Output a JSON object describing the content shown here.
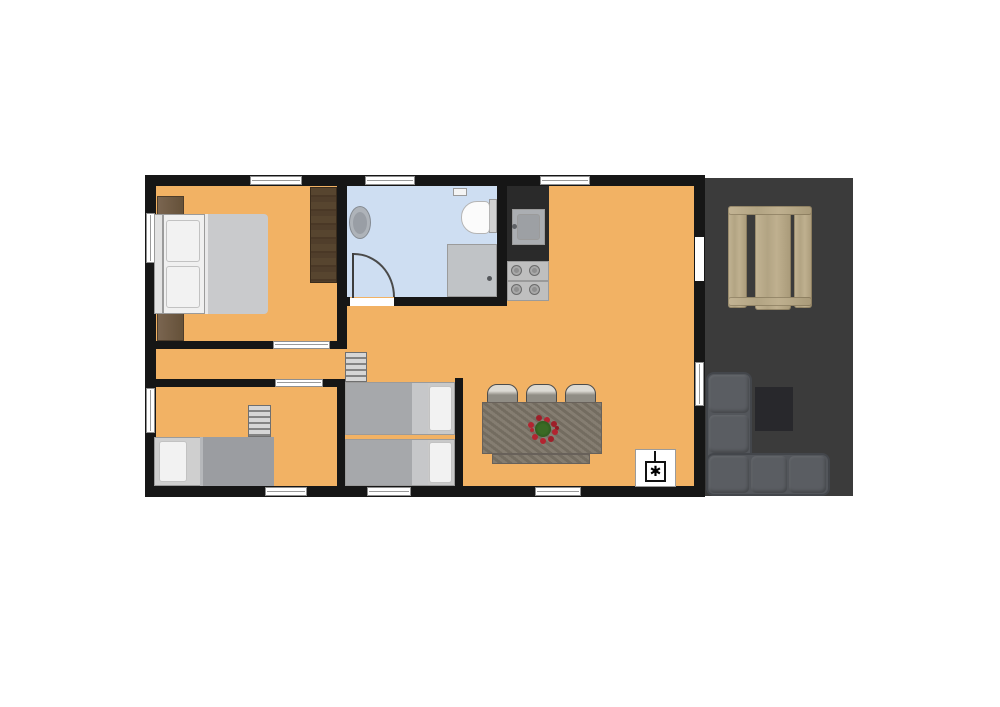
{
  "plan": {
    "canvas": {
      "width": 1000,
      "height": 707
    },
    "colors": {
      "wall": "#161616",
      "floor": "#F2B264",
      "bathroom_floor": "#CEDEF2",
      "terrace_deck": "#3B3B3B",
      "picnic_table_wood": "#B7A888",
      "kitchen_counter": "#2A2A2A",
      "sofa": "#53565B",
      "bed_blanket": "#A6A8AB",
      "plant_green": "#2F5C1E",
      "plant_red": "#B22430"
    },
    "symbols": {
      "heater": "✱"
    },
    "elements": [
      {
        "name": "terrace-deck",
        "rect": [
          703,
          178,
          150,
          318
        ],
        "bg": "#3B3B3B"
      },
      {
        "name": "picnic-table-left-bench",
        "cls": "wood",
        "rect": [
          728,
          208,
          19,
          100
        ]
      },
      {
        "name": "picnic-table-top",
        "cls": "wood",
        "rect": [
          755,
          206,
          36,
          104
        ]
      },
      {
        "name": "picnic-table-right-bench",
        "cls": "wood",
        "rect": [
          794,
          208,
          18,
          100
        ]
      },
      {
        "name": "picnic-table-crossbar-top",
        "cls": "wood",
        "rect": [
          728,
          206,
          84,
          9
        ]
      },
      {
        "name": "picnic-table-crossbar-bottom",
        "cls": "wood",
        "rect": [
          728,
          297,
          84,
          9
        ]
      },
      {
        "name": "terrace-side-table",
        "rect": [
          755,
          387,
          38,
          44
        ],
        "bg": "#28282C"
      },
      {
        "name": "sofa-chaise-section",
        "cls": "sofa",
        "rect": [
          706,
          372,
          46,
          124
        ]
      },
      {
        "name": "sofa-base-section",
        "cls": "sofa",
        "rect": [
          706,
          453,
          124,
          43
        ]
      },
      {
        "name": "sofa-cushion",
        "cls": "cushion",
        "rect": [
          709,
          375,
          40,
          38
        ]
      },
      {
        "name": "sofa-cushion",
        "cls": "cushion",
        "rect": [
          709,
          415,
          40,
          38
        ]
      },
      {
        "name": "sofa-cushion",
        "cls": "cushion",
        "rect": [
          709,
          456,
          40,
          37
        ]
      },
      {
        "name": "sofa-cushion",
        "cls": "cushion",
        "rect": [
          751,
          456,
          36,
          37
        ]
      },
      {
        "name": "sofa-cushion",
        "cls": "cushion",
        "rect": [
          789,
          456,
          37,
          37
        ]
      },
      {
        "name": "house-floor",
        "rect": [
          150,
          180,
          550,
          312
        ],
        "bg": "#F2B264"
      },
      {
        "name": "bathroom-floor",
        "rect": [
          347,
          186,
          150,
          111
        ],
        "bg": "#CEDEF2"
      },
      {
        "name": "wall-top",
        "rect": [
          145,
          175,
          560,
          11
        ],
        "bg": "#161616"
      },
      {
        "name": "wall-bottom",
        "rect": [
          145,
          486,
          560,
          11
        ],
        "bg": "#161616"
      },
      {
        "name": "wall-left",
        "rect": [
          145,
          175,
          11,
          322
        ],
        "bg": "#161616"
      },
      {
        "name": "wall-right",
        "rect": [
          694,
          175,
          11,
          322
        ],
        "bg": "#161616"
      },
      {
        "name": "wall-bathroom-left",
        "rect": [
          337,
          186,
          10,
          163
        ],
        "bg": "#161616"
      },
      {
        "name": "wall-bathroom-right",
        "rect": [
          497,
          186,
          10,
          120
        ],
        "bg": "#161616"
      },
      {
        "name": "wall-bathroom-bottom-left",
        "rect": [
          337,
          297,
          13,
          9
        ],
        "bg": "#161616"
      },
      {
        "name": "wall-bathroom-bottom-right",
        "rect": [
          394,
          297,
          113,
          9
        ],
        "bg": "#161616"
      },
      {
        "name": "wall-bedroom-bottom-left",
        "rect": [
          145,
          341,
          128,
          8
        ],
        "bg": "#161616"
      },
      {
        "name": "wall-bedroom-bottom-right",
        "rect": [
          330,
          341,
          17,
          8
        ],
        "bg": "#161616"
      },
      {
        "name": "wall-hall-bottom-left",
        "rect": [
          145,
          379,
          130,
          8
        ],
        "bg": "#161616"
      },
      {
        "name": "wall-hall-bottom-right",
        "rect": [
          323,
          379,
          22,
          8
        ],
        "bg": "#161616"
      },
      {
        "name": "wall-alcove-left",
        "rect": [
          337,
          383,
          8,
          103
        ],
        "bg": "#161616"
      },
      {
        "name": "wall-alcove-right",
        "rect": [
          455,
          378,
          8,
          108
        ],
        "bg": "#161616"
      },
      {
        "name": "kitchen-counter",
        "rect": [
          507,
          186,
          42,
          75
        ],
        "bg": "#2A2A2A"
      },
      {
        "name": "window-top-bedroom",
        "cls": "win-h",
        "rect": [
          250,
          176,
          52,
          9
        ]
      },
      {
        "name": "window-top-bathroom",
        "cls": "win-h",
        "rect": [
          365,
          176,
          50,
          9
        ]
      },
      {
        "name": "window-top-living",
        "cls": "win-h",
        "rect": [
          540,
          176,
          50,
          9
        ]
      },
      {
        "name": "window-bottom-left-room",
        "cls": "win-h",
        "rect": [
          265,
          487,
          42,
          9
        ]
      },
      {
        "name": "window-bottom-alcove",
        "cls": "win-h",
        "rect": [
          367,
          487,
          44,
          9
        ]
      },
      {
        "name": "window-bottom-living",
        "cls": "win-h",
        "rect": [
          535,
          487,
          46,
          9
        ]
      },
      {
        "name": "window-left-bedroom",
        "cls": "win-v",
        "rect": [
          146,
          213,
          9,
          50
        ]
      },
      {
        "name": "window-left-bottom-room",
        "cls": "win-v",
        "rect": [
          146,
          388,
          9,
          45
        ]
      },
      {
        "name": "window-right-living",
        "cls": "win-v",
        "rect": [
          695,
          362,
          9,
          44
        ]
      },
      {
        "name": "entry-door-opening",
        "cls": "door-open",
        "rect": [
          695,
          237,
          9,
          44
        ]
      },
      {
        "name": "bathroom-door-opening",
        "cls": "door-open",
        "rect": [
          350,
          298,
          44,
          8
        ]
      },
      {
        "name": "bedroom-door-opening",
        "cls": "win-h",
        "rect": [
          273,
          341,
          57,
          8
        ]
      },
      {
        "name": "bottom-room-door-opening",
        "cls": "win-h",
        "rect": [
          275,
          379,
          48,
          8
        ]
      },
      {
        "name": "bathroom-door-leaf",
        "rect": [
          352,
          253,
          2,
          45
        ],
        "bg": "#3d3d3d"
      },
      {
        "name": "bathroom-door-swing-arc",
        "cls": "arc",
        "rect": [
          354,
          253,
          41,
          44
        ]
      },
      {
        "name": "bathroom-shelf",
        "cls": "thin-border",
        "rect": [
          453,
          188,
          14,
          8
        ],
        "bg": "#F4F4F4"
      },
      {
        "name": "toilet-tank",
        "cls": "thin-border",
        "rect": [
          489,
          199,
          8,
          34
        ],
        "bg": "#D2D2D2"
      },
      {
        "name": "toilet-bowl",
        "cls": "pill-left",
        "rect": [
          461,
          201,
          29,
          33
        ],
        "bg": "#FBFBFB"
      },
      {
        "name": "bathroom-sink",
        "cls": "ellipse sink-outer",
        "rect": [
          349,
          206,
          22,
          33
        ],
        "bg": "#AEB3B9"
      },
      {
        "name": "bathroom-sink-basin",
        "cls": "ellipse",
        "rect": [
          353,
          212,
          14,
          22
        ],
        "bg": "#999EA5"
      },
      {
        "name": "shower-tray",
        "cls": "thin-border",
        "rect": [
          447,
          244,
          50,
          53
        ],
        "bg": "#C0C3C6"
      },
      {
        "name": "shower-drain",
        "cls": "ellipse",
        "rect": [
          487,
          276,
          5,
          5
        ],
        "bg": "#55585C"
      },
      {
        "name": "kitchen-sink-outer",
        "cls": "thin-border",
        "rect": [
          512,
          209,
          33,
          36
        ],
        "bg": "#ABAEB2"
      },
      {
        "name": "kitchen-sink-basin",
        "cls": "thin-border r2",
        "rect": [
          517,
          214,
          23,
          26
        ],
        "bg": "#9DA0A4"
      },
      {
        "name": "kitchen-faucet",
        "cls": "ellipse",
        "rect": [
          512,
          224,
          5,
          5
        ],
        "bg": "#5F6266"
      },
      {
        "name": "stove",
        "cls": "thin-border",
        "rect": [
          507,
          261,
          42,
          40
        ],
        "bg": "#BFBFBF"
      },
      {
        "name": "stove-divider",
        "rect": [
          507,
          280,
          42,
          2
        ],
        "bg": "#9A9A9A"
      },
      {
        "name": "stove-burner",
        "cls": "burner",
        "rect": [
          511,
          265,
          11,
          11
        ]
      },
      {
        "name": "stove-burner",
        "cls": "burner",
        "rect": [
          529,
          265,
          11,
          11
        ]
      },
      {
        "name": "stove-burner",
        "cls": "burner",
        "rect": [
          511,
          284,
          11,
          11
        ]
      },
      {
        "name": "stove-burner",
        "cls": "burner",
        "rect": [
          529,
          284,
          11,
          11
        ]
      },
      {
        "name": "nightstand",
        "cls": "nightstand",
        "rect": [
          157,
          196,
          27,
          37
        ]
      },
      {
        "name": "nightstand",
        "cls": "nightstand",
        "rect": [
          157,
          304,
          27,
          37
        ]
      },
      {
        "name": "double-bed-headboard",
        "cls": "thin-border",
        "rect": [
          154,
          214,
          9,
          100
        ],
        "bg": "#E3E3E3"
      },
      {
        "name": "double-bed-sheet",
        "cls": "thin-border",
        "rect": [
          163,
          214,
          42,
          100
        ],
        "bg": "#F0F0F0"
      },
      {
        "name": "bed-pillow",
        "cls": "pillow",
        "rect": [
          166,
          220,
          34,
          42
        ]
      },
      {
        "name": "bed-pillow",
        "cls": "pillow",
        "rect": [
          166,
          266,
          34,
          42
        ]
      },
      {
        "name": "double-bed-blanket",
        "cls": "blanket",
        "rect": [
          205,
          214,
          63,
          100
        ],
        "bg": "#C9CACC"
      },
      {
        "name": "wardrobe",
        "cls": "wardrobe",
        "rect": [
          310,
          187,
          27,
          96
        ]
      },
      {
        "name": "loft-ladder-living",
        "cls": "ladder",
        "rect": [
          345,
          352,
          22,
          30
        ]
      },
      {
        "name": "dining-stool",
        "cls": "stool",
        "rect": [
          487,
          384,
          31,
          20
        ]
      },
      {
        "name": "dining-stool",
        "cls": "stool",
        "rect": [
          526,
          384,
          31,
          20
        ]
      },
      {
        "name": "dining-stool",
        "cls": "stool",
        "rect": [
          565,
          384,
          31,
          20
        ]
      },
      {
        "name": "dining-table",
        "cls": "table-tex",
        "rect": [
          482,
          402,
          120,
          52
        ]
      },
      {
        "name": "dining-table-end",
        "cls": "table-tex",
        "rect": [
          492,
          454,
          98,
          10
        ]
      },
      {
        "name": "table-plant-centerpiece",
        "cls": "plant",
        "rect": [
          535,
          421,
          16,
          16
        ]
      },
      {
        "name": "heater-panel",
        "cls": "thin-border",
        "rect": [
          635,
          449,
          41,
          38
        ],
        "bg": "#FFFFFF"
      },
      {
        "name": "heater-stem",
        "rect": [
          654,
          451,
          2,
          10
        ],
        "bg": "#111111"
      },
      {
        "name": "heater-box",
        "cls": "heater-box",
        "rect": [
          645,
          461,
          21,
          21
        ],
        "text": "✱"
      },
      {
        "name": "single-bed-frame",
        "cls": "thin-border",
        "rect": [
          154,
          437,
          120,
          49
        ],
        "bg": "#CFCFCF"
      },
      {
        "name": "single-bed-pillow",
        "cls": "pillow",
        "rect": [
          159,
          441,
          28,
          41
        ]
      },
      {
        "name": "single-bed-blanket",
        "cls": "blanket2",
        "rect": [
          200,
          437,
          74,
          49
        ],
        "bg": "#9B9DA1"
      },
      {
        "name": "loft-ladder-bottom-room",
        "cls": "ladder",
        "rect": [
          248,
          405,
          23,
          32
        ]
      },
      {
        "name": "bunk-bed-frame",
        "cls": "thin-border",
        "rect": [
          345,
          382,
          110,
          53
        ],
        "bg": "#C9C9C9"
      },
      {
        "name": "bunk-bed-blanket",
        "rect": [
          346,
          383,
          66,
          51
        ],
        "bg": "#A6A8AB"
      },
      {
        "name": "bunk-bed-mid",
        "rect": [
          412,
          383,
          16,
          51
        ],
        "bg": "#C6C7C9"
      },
      {
        "name": "bunk-bed-pillow",
        "cls": "pillow",
        "rect": [
          429,
          386,
          23,
          45
        ]
      },
      {
        "name": "bunk-bed-frame",
        "cls": "thin-border",
        "rect": [
          345,
          439,
          110,
          47
        ],
        "bg": "#C9C9C9"
      },
      {
        "name": "bunk-bed-blanket",
        "rect": [
          346,
          440,
          66,
          45
        ],
        "bg": "#A6A8AB"
      },
      {
        "name": "bunk-bed-mid",
        "rect": [
          412,
          440,
          16,
          45
        ],
        "bg": "#C6C7C9"
      },
      {
        "name": "bunk-bed-pillow",
        "cls": "pillow",
        "rect": [
          429,
          442,
          23,
          41
        ]
      }
    ]
  }
}
